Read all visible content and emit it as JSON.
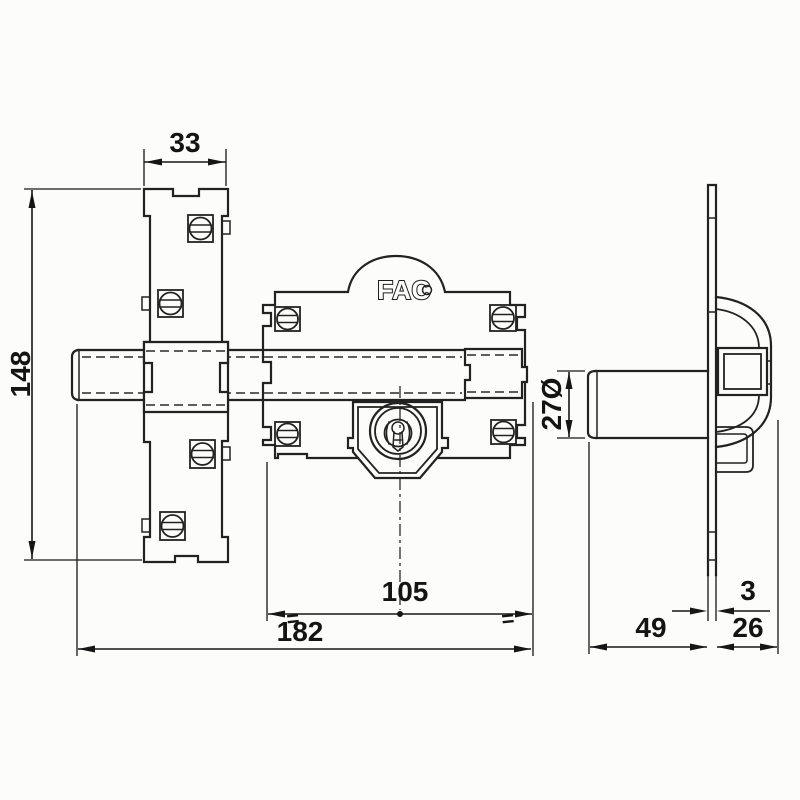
{
  "drawing": {
    "logo": "FAC",
    "colors": {
      "line": "#222222",
      "background": "#fcfcfa",
      "dim_text": "#141414"
    }
  },
  "dimensions": {
    "plate_width": {
      "value": "33"
    },
    "plate_height": {
      "value": "148"
    },
    "body_width": {
      "value": "105"
    },
    "total_length": {
      "value": "182"
    },
    "bolt_diameter": {
      "value": "27Ø"
    },
    "body_depth": {
      "value": "49"
    },
    "rear_depth": {
      "value": "26"
    },
    "plate_thickness": {
      "value": "3"
    },
    "equal_mark": "="
  }
}
